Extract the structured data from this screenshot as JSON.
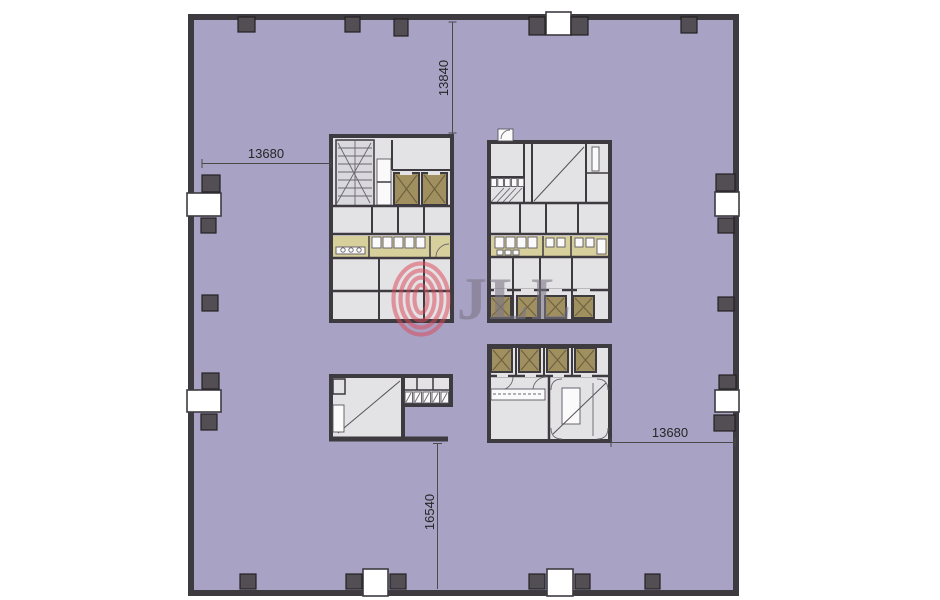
{
  "colors": {
    "floor": "#a8a2c4",
    "wall": "#3e3b40",
    "column": "#524e53",
    "column_border": "#232124",
    "room": "#e3e2e5",
    "room2": "#d9d8dc",
    "corridor": "#d8d09c",
    "shaft": "#a1905f",
    "shaft_line": "#6f6242",
    "fixture": "#fafafa",
    "dim_line": "#4a4a4a",
    "dim_text": "#262626",
    "logo_red": "#dd4a59",
    "logo_gray": "#7b7685"
  },
  "dimensions": {
    "top": {
      "label": "13840"
    },
    "left": {
      "label": "13680"
    },
    "right": {
      "label": "13680"
    },
    "bottom": {
      "label": "16540"
    }
  },
  "watermark": {
    "logo_text": "JLL"
  }
}
